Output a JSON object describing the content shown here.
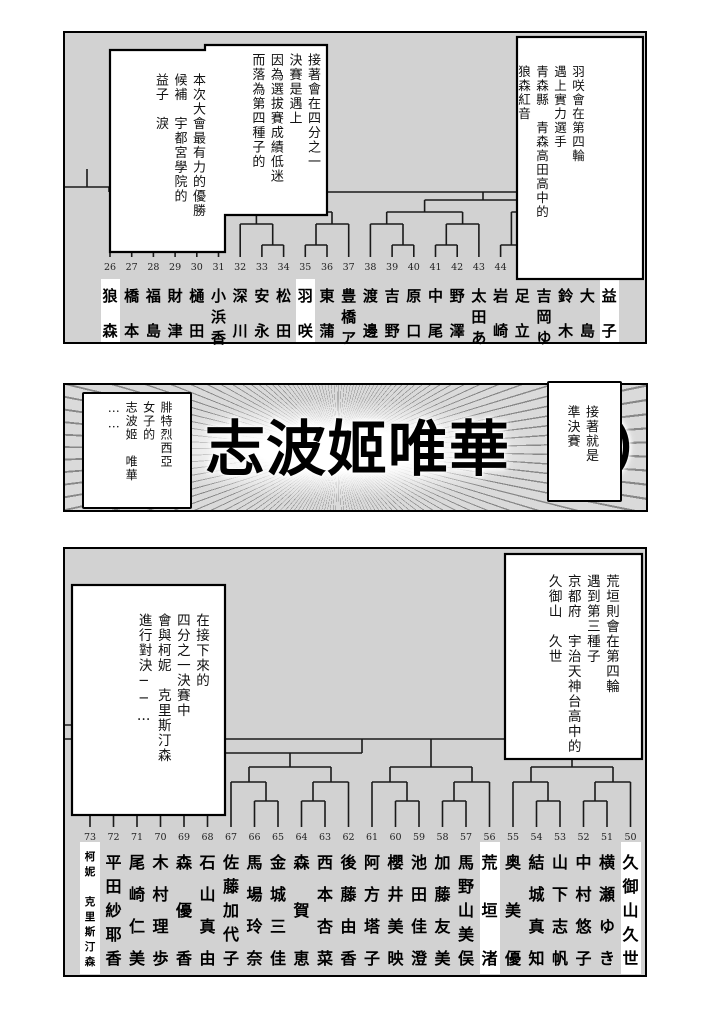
{
  "colors": {
    "panel_bg": "#d2d2d2",
    "bubble_bg": "#ffffff",
    "line": "#1a1a1a",
    "highlight": "#ffffff"
  },
  "panels": {
    "top": {
      "bubble_main": {
        "cols": [
          "接著會在四分之一",
          "決賽是遇上",
          "因為選拔賽成績低迷",
          "而落為第四種子的"
        ],
        "cols2": [
          "本次大會最有力的優勝",
          "候補　宇都宮學院的",
          "益子　淚"
        ]
      },
      "bubble_side": {
        "cols": [
          "羽咲會在第四輪",
          "遇上實力選手",
          "青森縣　青森高田高中的",
          "狼森紅音"
        ]
      },
      "seeds": [
        {
          "n": "26",
          "name": "狼森",
          "hl": true
        },
        {
          "n": "27",
          "name": "橋本"
        },
        {
          "n": "28",
          "name": "福島"
        },
        {
          "n": "29",
          "name": "財津"
        },
        {
          "n": "30",
          "name": "樋田"
        },
        {
          "n": "31",
          "name": "小浜香"
        },
        {
          "n": "32",
          "name": "深川"
        },
        {
          "n": "33",
          "name": "安永"
        },
        {
          "n": "34",
          "name": "松田"
        },
        {
          "n": "35",
          "name": "羽咲",
          "hl": true
        },
        {
          "n": "36",
          "name": "東蒲"
        },
        {
          "n": "37",
          "name": "豊橋ア"
        },
        {
          "n": "38",
          "name": "渡邊"
        },
        {
          "n": "39",
          "name": "吉野"
        },
        {
          "n": "40",
          "name": "原口"
        },
        {
          "n": "41",
          "name": "中尾"
        },
        {
          "n": "42",
          "name": "野澤"
        },
        {
          "n": "43",
          "name": "太田あ"
        },
        {
          "n": "44",
          "name": "岩崎"
        },
        {
          "n": "",
          "name": "足立"
        },
        {
          "n": "",
          "name": "吉岡ゆ"
        },
        {
          "n": "",
          "name": "鈴木"
        },
        {
          "n": "",
          "name": "大島"
        },
        {
          "n": "",
          "name": "益子",
          "hl": true
        }
      ]
    },
    "middle": {
      "big_text": "志波姬唯華（",
      "paren_tail": "）",
      "bubble_left": {
        "cols": [
          "腓特烈西亞",
          "女子的",
          "志波姬　唯華",
          "……"
        ]
      },
      "bubble_right": {
        "cols": [
          "接著就是",
          "準決賽"
        ]
      }
    },
    "bottom": {
      "bubble_left": {
        "cols": [
          "在接下來的",
          "四分之一決賽中",
          "會與柯妮　克里斯汀森",
          "進行對決──…"
        ]
      },
      "bubble_right": {
        "cols": [
          "荒垣則會在第四輪",
          "遇到第三種子",
          "京都府　宇治天神台高中的",
          "久御山　久世"
        ]
      },
      "seeds": [
        {
          "n": "73",
          "name": "柯妮　克里斯汀森",
          "hl": true,
          "small": true
        },
        {
          "n": "72",
          "name": "平田紗耶香"
        },
        {
          "n": "71",
          "name": "尾崎仁美"
        },
        {
          "n": "70",
          "name": "木村理歩"
        },
        {
          "n": "69",
          "name": "森優香"
        },
        {
          "n": "68",
          "name": "石山真由"
        },
        {
          "n": "67",
          "name": "佐藤加代子"
        },
        {
          "n": "66",
          "name": "馬場玲奈"
        },
        {
          "n": "65",
          "name": "金城三佳"
        },
        {
          "n": "64",
          "name": "森賀恵"
        },
        {
          "n": "63",
          "name": "西本杏菜"
        },
        {
          "n": "62",
          "name": "後藤由香"
        },
        {
          "n": "61",
          "name": "阿方塔子"
        },
        {
          "n": "60",
          "name": "櫻井美映"
        },
        {
          "n": "59",
          "name": "池田佳澄"
        },
        {
          "n": "58",
          "name": "加藤友美"
        },
        {
          "n": "57",
          "name": "馬野山美俣"
        },
        {
          "n": "56",
          "name": "荒垣渚",
          "hl": true
        },
        {
          "n": "55",
          "name": "奥美優"
        },
        {
          "n": "54",
          "name": "結城真知"
        },
        {
          "n": "53",
          "name": "山下志帆"
        },
        {
          "n": "52",
          "name": "中村悠子"
        },
        {
          "n": "51",
          "name": "横瀬ゆき"
        },
        {
          "n": "50",
          "name": "久御山久世",
          "hl": true
        }
      ]
    }
  },
  "bracket_lines": {
    "top": [
      [
        45,
        224,
        45,
        191
      ],
      [
        66.7,
        224,
        66.7,
        212
      ],
      [
        88.4,
        224,
        88.4,
        212
      ],
      [
        110.1,
        224,
        110.1,
        212
      ],
      [
        131.8,
        224,
        131.8,
        212
      ],
      [
        153.5,
        224,
        153.5,
        191
      ],
      [
        175.2,
        224,
        175.2,
        191
      ],
      [
        196.9,
        224,
        196.9,
        212
      ],
      [
        218.6,
        224,
        218.6,
        212
      ],
      [
        240.3,
        224,
        240.3,
        212
      ],
      [
        262,
        224,
        262,
        212
      ],
      [
        283.7,
        224,
        283.7,
        191
      ],
      [
        305.4,
        224,
        305.4,
        191
      ],
      [
        327.1,
        224,
        327.1,
        212
      ],
      [
        348.8,
        224,
        348.8,
        212
      ],
      [
        370.5,
        224,
        370.5,
        212
      ],
      [
        392.2,
        224,
        392.2,
        212
      ],
      [
        413.9,
        224,
        413.9,
        191
      ],
      [
        435.6,
        224,
        435.6,
        212
      ],
      [
        457.3,
        224,
        457.3,
        212
      ],
      [
        479,
        224,
        479,
        212
      ],
      [
        500.7,
        224,
        500.7,
        212
      ],
      [
        522.4,
        224,
        522.4,
        191
      ],
      [
        544.1,
        224,
        544.1,
        159
      ],
      [
        66.7,
        212,
        88.4,
        212
      ],
      [
        110.1,
        212,
        131.8,
        212
      ],
      [
        196.9,
        212,
        218.6,
        212
      ],
      [
        240.3,
        212,
        262,
        212
      ],
      [
        327.1,
        212,
        348.8,
        212
      ],
      [
        370.5,
        212,
        392.2,
        212
      ],
      [
        435.6,
        212,
        457.3,
        212
      ],
      [
        479,
        212,
        500.7,
        212
      ],
      [
        77.5,
        212,
        77.5,
        191
      ],
      [
        121,
        212,
        121,
        191
      ],
      [
        207.7,
        212,
        207.7,
        191
      ],
      [
        251,
        212,
        251,
        191
      ],
      [
        338,
        212,
        338,
        191
      ],
      [
        381.3,
        212,
        381.3,
        191
      ],
      [
        446.4,
        212,
        446.4,
        179
      ],
      [
        489.8,
        212,
        489.8,
        191
      ],
      [
        45,
        191,
        77.5,
        191
      ],
      [
        121,
        191,
        153.5,
        191
      ],
      [
        175.2,
        191,
        207.7,
        191
      ],
      [
        251,
        191,
        283.7,
        191
      ],
      [
        305.4,
        191,
        338,
        191
      ],
      [
        381.3,
        191,
        413.9,
        191
      ],
      [
        489.8,
        191,
        522.4,
        191
      ],
      [
        61,
        191,
        61,
        179
      ],
      [
        137,
        191,
        137,
        179
      ],
      [
        191.4,
        191,
        191.4,
        179
      ],
      [
        267,
        191,
        267,
        179
      ],
      [
        321.7,
        191,
        321.7,
        179
      ],
      [
        397.6,
        191,
        397.6,
        179
      ],
      [
        506,
        191,
        506,
        179
      ],
      [
        61,
        179,
        137,
        179
      ],
      [
        191.4,
        179,
        267,
        179
      ],
      [
        321.7,
        179,
        397.6,
        179
      ],
      [
        446.4,
        179,
        506,
        179
      ],
      [
        99,
        179,
        99,
        167
      ],
      [
        229,
        179,
        229,
        167
      ],
      [
        359.6,
        179,
        359.6,
        167
      ],
      [
        476,
        179,
        476,
        167
      ],
      [
        99,
        167,
        229,
        167
      ],
      [
        359.6,
        167,
        476,
        167
      ],
      [
        164,
        167,
        164,
        159
      ],
      [
        418,
        167,
        418,
        159
      ],
      [
        44,
        159,
        544.1,
        159
      ],
      [
        0,
        154,
        44,
        154
      ],
      [
        22,
        136,
        22,
        154
      ],
      [
        44,
        154,
        44,
        159
      ]
    ],
    "bottom": [
      [
        25,
        278,
        25,
        204
      ],
      [
        48.5,
        278,
        48.5,
        252
      ],
      [
        72,
        278,
        72,
        252
      ],
      [
        95.5,
        278,
        95.5,
        252
      ],
      [
        119,
        278,
        119,
        252
      ],
      [
        142.5,
        278,
        142.5,
        233
      ],
      [
        166,
        278,
        166,
        233
      ],
      [
        189.5,
        278,
        189.5,
        252
      ],
      [
        213,
        278,
        213,
        252
      ],
      [
        236.5,
        278,
        236.5,
        252
      ],
      [
        260,
        278,
        260,
        252
      ],
      [
        283.5,
        278,
        283.5,
        233
      ],
      [
        307,
        278,
        307,
        233
      ],
      [
        330.5,
        278,
        330.5,
        252
      ],
      [
        354,
        278,
        354,
        252
      ],
      [
        377.5,
        278,
        377.5,
        252
      ],
      [
        401,
        278,
        401,
        252
      ],
      [
        424.5,
        278,
        424.5,
        233
      ],
      [
        448,
        278,
        448,
        233
      ],
      [
        471.5,
        278,
        471.5,
        252
      ],
      [
        495,
        278,
        495,
        252
      ],
      [
        518.5,
        278,
        518.5,
        252
      ],
      [
        542,
        278,
        542,
        252
      ],
      [
        565.5,
        278,
        565.5,
        233
      ],
      [
        48.5,
        252,
        72,
        252
      ],
      [
        95.5,
        252,
        119,
        252
      ],
      [
        189.5,
        252,
        213,
        252
      ],
      [
        236.5,
        252,
        260,
        252
      ],
      [
        330.5,
        252,
        354,
        252
      ],
      [
        377.5,
        252,
        401,
        252
      ],
      [
        471.5,
        252,
        495,
        252
      ],
      [
        518.5,
        252,
        542,
        252
      ],
      [
        60,
        252,
        60,
        218
      ],
      [
        107,
        252,
        107,
        233
      ],
      [
        201,
        252,
        201,
        233
      ],
      [
        248,
        252,
        248,
        233
      ],
      [
        342,
        252,
        342,
        233
      ],
      [
        389,
        252,
        389,
        233
      ],
      [
        483,
        252,
        483,
        233
      ],
      [
        530,
        252,
        530,
        233
      ],
      [
        107,
        233,
        142.5,
        233
      ],
      [
        166,
        233,
        201,
        233
      ],
      [
        248,
        233,
        283.5,
        233
      ],
      [
        307,
        233,
        342,
        233
      ],
      [
        389,
        233,
        424.5,
        233
      ],
      [
        448,
        233,
        483,
        233
      ],
      [
        530,
        233,
        565.5,
        233
      ],
      [
        125,
        233,
        125,
        218
      ],
      [
        184,
        233,
        184,
        218
      ],
      [
        266,
        233,
        266,
        218
      ],
      [
        325,
        233,
        325,
        218
      ],
      [
        407,
        233,
        407,
        218
      ],
      [
        466,
        233,
        466,
        218
      ],
      [
        548,
        233,
        548,
        218
      ],
      [
        60,
        218,
        125,
        218
      ],
      [
        184,
        218,
        266,
        218
      ],
      [
        325,
        218,
        407,
        218
      ],
      [
        466,
        218,
        548,
        218
      ],
      [
        92,
        218,
        92,
        204
      ],
      [
        225,
        218,
        225,
        204
      ],
      [
        366,
        218,
        366,
        190
      ],
      [
        507,
        218,
        507,
        190
      ],
      [
        25,
        204,
        297,
        204
      ],
      [
        297,
        190,
        297,
        204
      ],
      [
        0,
        190,
        507,
        190
      ],
      [
        141,
        176,
        141,
        190
      ],
      [
        0,
        176,
        141,
        176
      ]
    ]
  }
}
